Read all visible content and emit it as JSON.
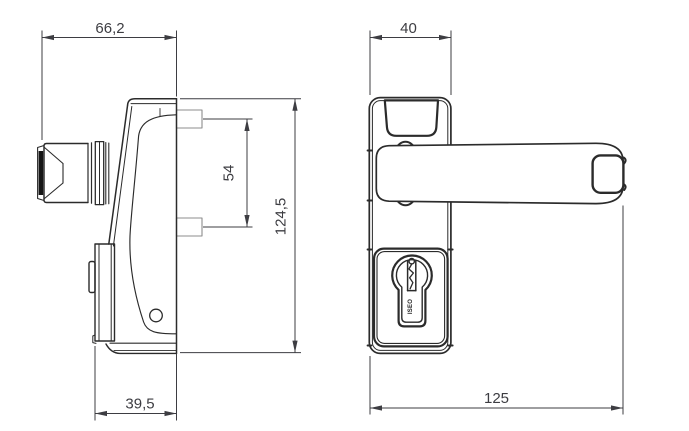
{
  "drawing": {
    "side_view": {
      "dimensions": {
        "overall_depth": "66,2",
        "fixing_centres": "54",
        "plate_height": "124,5",
        "body_depth": "39,5"
      }
    },
    "front_view": {
      "dimensions": {
        "plate_width": "40",
        "overall_length": "125"
      },
      "cylinder_mark": "ISEO"
    },
    "colors": {
      "line": "#2b2b2b",
      "light_line": "#8c8c8c",
      "dimension": "#3d3d42",
      "background": "#ffffff"
    }
  }
}
